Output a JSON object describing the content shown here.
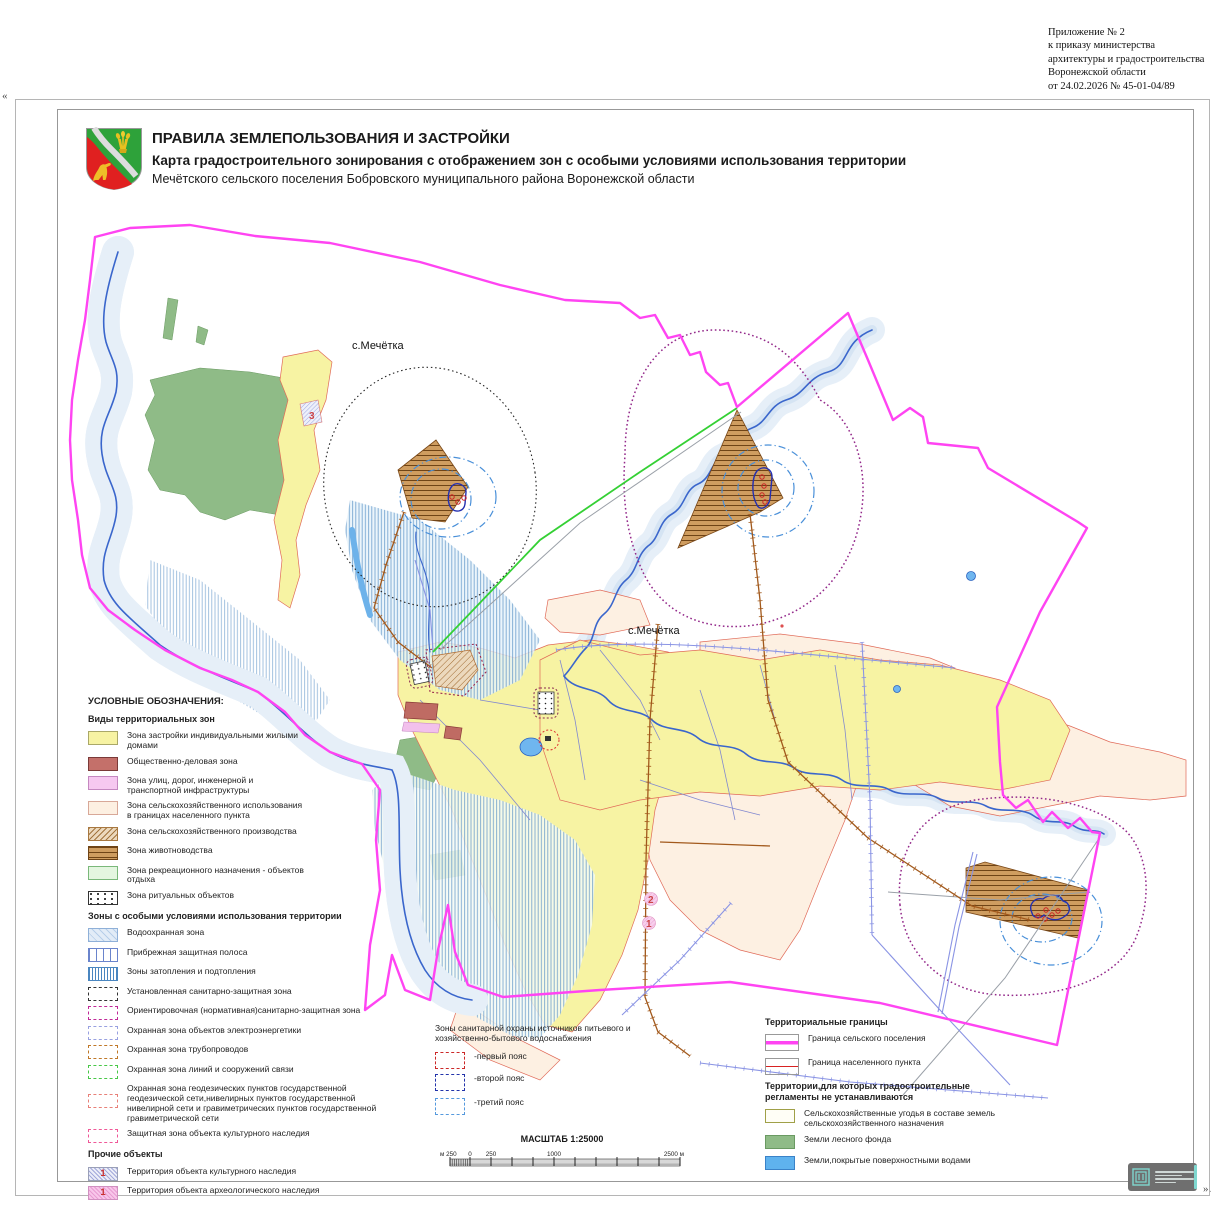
{
  "annotation": {
    "line1": "Приложение № 2",
    "line2": "к приказу министерства",
    "line3": "архитектуры и градостроительства",
    "line4": "Воронежской области",
    "line5": "от 24.02.2026 № 45-01-04/89"
  },
  "corner_marks": {
    "left": "«",
    "right": "»."
  },
  "header": {
    "title_line1": "ПРАВИЛА ЗЕМЛЕПОЛЬЗОВАНИЯ И ЗАСТРОЙКИ",
    "title_line2": "Карта градостроительного зонирования с отображением зон с особыми условиями использования территории",
    "title_line3": "Мечётского сельского поселения Бобровского муниципального района Воронежской области"
  },
  "map": {
    "settlement_label_north": "с.Мечётка",
    "settlement_label_south": "с.Мечётка",
    "marker_1": "1",
    "marker_2": "2",
    "marker_3": "3"
  },
  "legend": {
    "title": "УСЛОВНЫЕ ОБОЗНАЧЕНИЯ:",
    "zones_title": "Виды территориальных зон",
    "zones": [
      "Зона застройки индивидуальными жилыми домами",
      "Общественно-деловая зона",
      "Зона улиц, дорог, инженерной и транспортной инфраструктуры",
      "Зона сельскохозяйственного использования в границах населенного пункта",
      "Зона сельскохозяйственного производства",
      "Зона животноводства",
      "Зона рекреационного назначения - объектов отдыха",
      "Зона ритуальных объектов"
    ],
    "special_title": "Зоны  с особыми условиями использования территории",
    "special": [
      "Водоохранная зона",
      "Прибрежная защитная полоса",
      "Зоны затопления и подтопления",
      "Установленная санитарно-защитная зона",
      "Ориентировочная (нормативная)санитарно-защитная зона",
      "Охранная зона объектов электроэнергетики",
      "Охранная зона трубопроводов",
      "Охранная зона линий и сооружений связи",
      "Охранная зона геодезических пунктов государственной геодезической сети,нивелирных пунктов государственной нивелирной сети и гравиметрических пунктов государственной гравиметрической сети",
      "Защитная зона объекта культурного наследия"
    ],
    "other_title": "Прочие объекты",
    "other": [
      {
        "badge": "1",
        "label": "Территория объекта культурного наследия"
      },
      {
        "badge": "1",
        "label": "Территория объекта археологического наследия"
      }
    ]
  },
  "sanitary_legend": {
    "title": "Зоны санитарной охраны источников питьевого и хозяйственно-бытового водоснабжения",
    "items": [
      "-первый пояс",
      "-второй пояс",
      "-третий пояс"
    ]
  },
  "boundaries_legend": {
    "title": "Территориальные границы",
    "items": [
      "Граница сельского поселения",
      "Граница населенного пункта"
    ],
    "no_reg_title": "Территории,для которых градостроительные регламенты не устанавливаются",
    "no_reg": [
      "Сельскохозяйственные угодья в составе земель сельскохозяйственного назначения",
      "Земли лесного фонда",
      "Земли,покрытые поверхностными водами"
    ]
  },
  "scale": {
    "title": "МАСШТАБ 1:25000",
    "labels": [
      "м 250",
      "0",
      "250",
      "1000",
      "2500 м"
    ]
  },
  "colors": {
    "settlement_boundary": "#ff44f2",
    "locality_boundary": "#d82222",
    "residential": "#f7f3a3",
    "agri_in_settlement": "#fdf0e2",
    "livestock": "#cf9d60",
    "forest": "#8fbb87",
    "surface_water": "#5fb2ee",
    "flood_hatch": "#4a86c0",
    "szz_established": "#333333",
    "szz_orient": "#c02898",
    "belt_first": "#cc2828",
    "belt_second": "#2233aa",
    "belt_third": "#5599dd"
  }
}
